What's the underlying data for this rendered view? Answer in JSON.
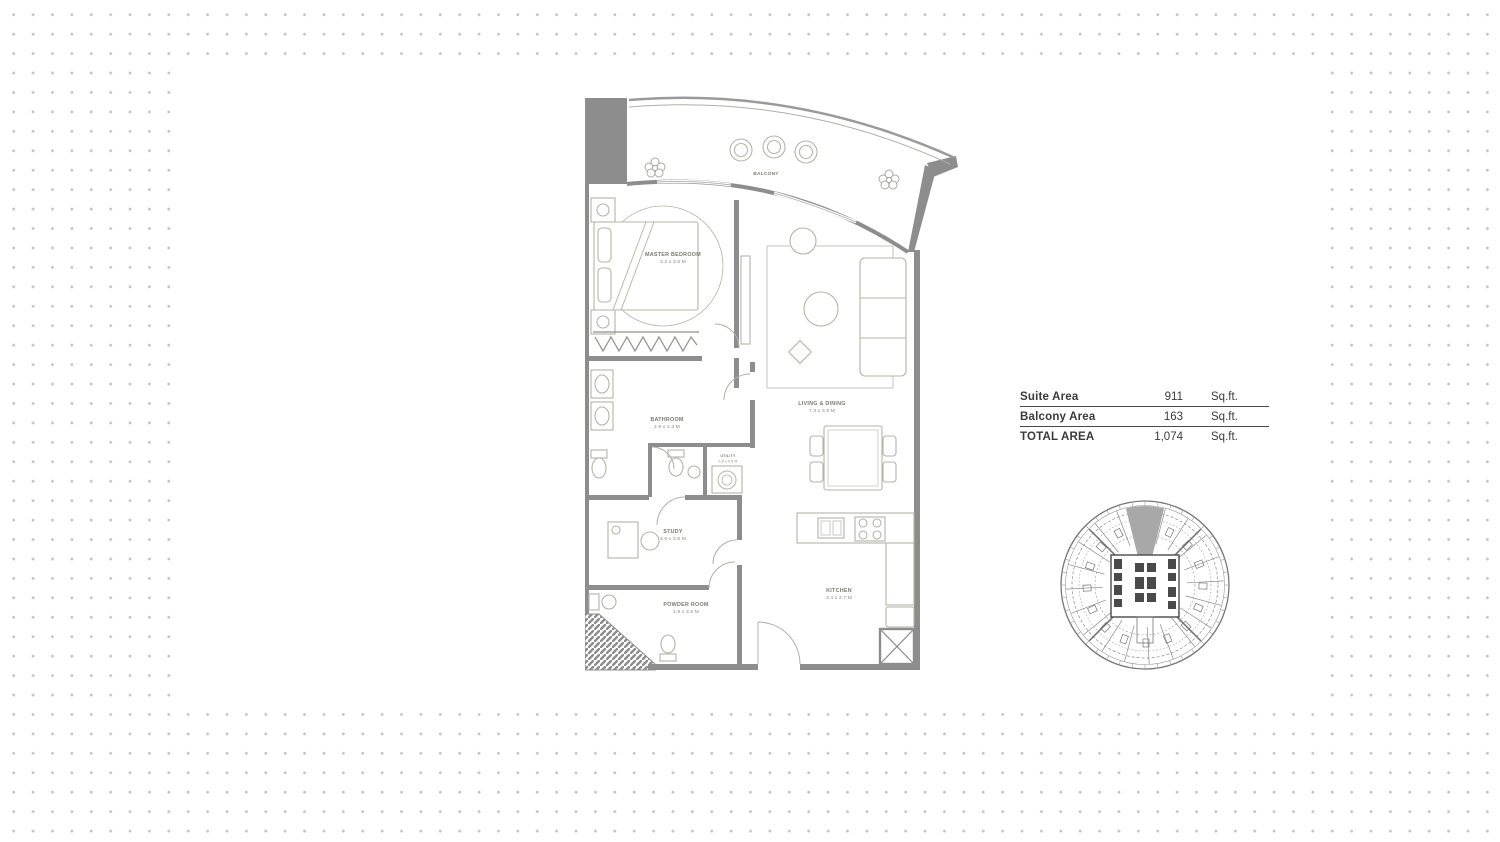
{
  "colors": {
    "wall_gray": "#8d8d8d",
    "furniture_gray": "#b4b4aa",
    "dot_gray": "#c4c4c4",
    "keyplan_highlight": "#a8a8a8",
    "table_text": "#3a3a3a"
  },
  "floor_plan": {
    "balcony_label": "BALCONY",
    "rooms": [
      {
        "label": "MASTER BEDROOM",
        "dims": "3.2 x 3.6 M"
      },
      {
        "label": "BATHROOM",
        "dims": "2.9 x 2.3 M"
      },
      {
        "label": "UTILITY",
        "dims": "0.8 x 0.9 M"
      },
      {
        "label": "STUDY",
        "dims": "3.0 x 3.6 M"
      },
      {
        "label": "POWDER ROOM",
        "dims": "1.9 x 3.6 M"
      },
      {
        "label": "LIVING & DINING",
        "dims": "7.3 x 3.9 M"
      },
      {
        "label": "KITCHEN",
        "dims": "3.4 x 2.7 M"
      }
    ]
  },
  "area_table": {
    "rows": [
      {
        "label": "Suite Area",
        "value": "911",
        "unit": "Sq.ft."
      },
      {
        "label": "Balcony Area",
        "value": "163",
        "unit": "Sq.ft."
      },
      {
        "label": "TOTAL AREA",
        "value": "1,074",
        "unit": "Sq.ft."
      }
    ]
  }
}
